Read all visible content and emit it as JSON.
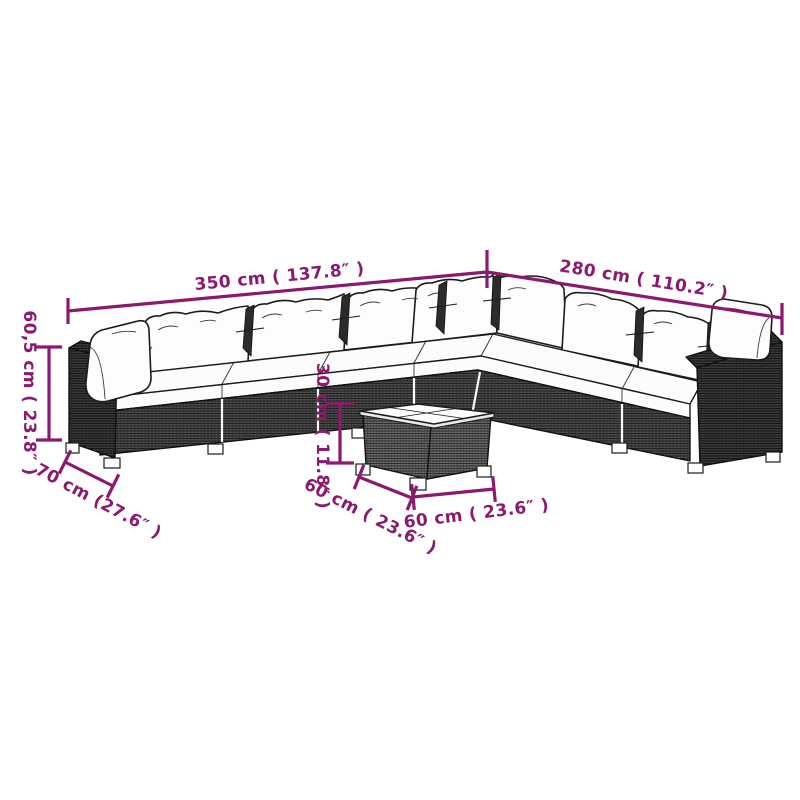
{
  "diagram": {
    "accent_color": "#8B1A6E",
    "line_art_color": "#1b1b1b",
    "background_color": "#ffffff",
    "dimensions": [
      {
        "id": "sofa-width-left",
        "label": "350 cm ( 137.8″ )"
      },
      {
        "id": "sofa-width-right",
        "label": "280 cm ( 110.2″ )"
      },
      {
        "id": "sofa-height",
        "label": "60,5 cm ( 23.8″ )"
      },
      {
        "id": "sofa-depth",
        "label": "70 cm (27.6″ )"
      },
      {
        "id": "table-height",
        "label": "30 cm ( 11.8″ )"
      },
      {
        "id": "table-side-left",
        "label": "60 cm ( 23.6″ )"
      },
      {
        "id": "table-side-right",
        "label": "60 cm ( 23.6″ )"
      }
    ]
  }
}
